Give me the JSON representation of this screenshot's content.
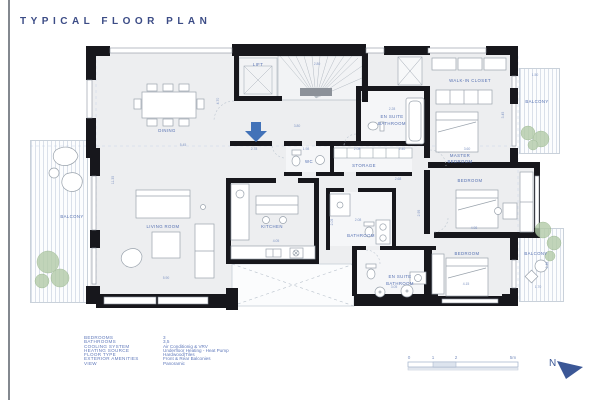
{
  "title": "TYPICAL FLOOR PLAN",
  "colors": {
    "accent": "#5570b2",
    "wall": "#17171c",
    "floor": "#edeef0",
    "plant": "#b3cba8",
    "north": "#3b5796"
  },
  "plan": {
    "rooms": {
      "dining": "DINING",
      "lift": "LIFT",
      "wc": "WC",
      "storage": "STORAGE",
      "kitchen": "KITCHEN",
      "bathroom": "BATHROOM",
      "ensuite_top_l1": "EN SUITE",
      "ensuite_top_l2": "BATHROOM",
      "ensuite_bottom_l1": "EN SUITE",
      "ensuite_bottom_l2": "BATHROOM",
      "walk_in_closet": "WALK-IN CLOSET",
      "master_l1": "MASTER",
      "master_l2": "BEDROOM",
      "bedroom_mid": "BEDROOM",
      "bedroom_bottom": "BEDROOM",
      "living": "LIVING ROOM",
      "balcony_left": "BALCONY",
      "balcony_top_right": "BALCONY",
      "balcony_bottom_right": "BALCONY"
    },
    "dims": {
      "d1": "5.45",
      "d2": "4.70",
      "d3": "11.35",
      "d4": "5.90",
      "d5": "4.05",
      "d6": "3.80",
      "d7": "2.80",
      "d8": "2.78",
      "d9": "1.98",
      "d10": "2.08",
      "d11": "2.40",
      "d12": "2.28",
      "d13": "2.68",
      "d14": "3.60",
      "d15": "3.45",
      "d16": "1.50",
      "d17": "4.98",
      "d18": "4.15",
      "d19": "1.70",
      "d20": "2.48",
      "d21": "3.05",
      "d22": "2.05",
      "d23": "2.95",
      "d24": "2.08"
    }
  },
  "legend": {
    "rows": [
      {
        "label": "BEDROOMS",
        "value": "3"
      },
      {
        "label": "BATHROOMS",
        "value": "3,5"
      },
      {
        "label": "COOLING SYSTEM",
        "value": "Air Conditionig & VRV"
      },
      {
        "label": "HEATING SOURCE",
        "value": "Underfloor Heating - Heat Pump"
      },
      {
        "label": "FLOOR TYPE",
        "value": "Hardwood|Tiles"
      },
      {
        "label": "EXTERIOR AMENITIES",
        "value": "Front & Rear Balconies"
      },
      {
        "label": "VIEW",
        "value": "Panoramic"
      }
    ]
  },
  "scale_bar": {
    "ticks": [
      "0",
      "1",
      "2",
      "5m"
    ]
  },
  "north": {
    "label": "N"
  }
}
